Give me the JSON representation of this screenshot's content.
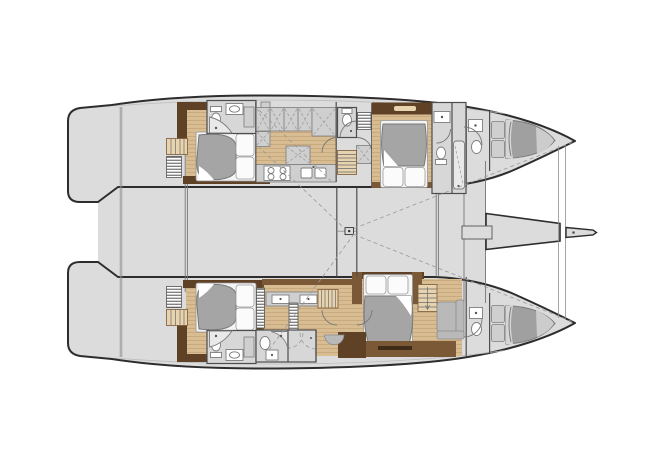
{
  "meta": {
    "type": "floorplan",
    "subject": "catamaran-yacht-interior-deck-plan",
    "orientation": "bow-right",
    "text_visible": "none"
  },
  "colors": {
    "background": "#ffffff",
    "hull_fill": "#dcdcdc",
    "hull_outline": "#2d2d2d",
    "wall": "#4d4d4d",
    "bath": "#d7d7d7",
    "wood": "#d8bc92",
    "wood_line": "#c2a276",
    "wood_light": "#e7d4ae",
    "brown_dark": "#5f4125",
    "brown_mid": "#7b5936",
    "counter": "#cfcfcf",
    "counter_line": "#7d7d7d",
    "fixture": "#ffffff",
    "duvet": "#a5a5a5",
    "duvet_dark": "#787878",
    "crew_bed": "#a0a0a0",
    "crew_bed_light": "#cccccc",
    "pillow": "#fbfbfb",
    "sofa": "#b9b9b9",
    "dash": "#999999"
  },
  "inventory": {
    "double_cabins": 4,
    "bow_crew_cabins": 2,
    "toilets": 7,
    "showers": 5,
    "stove_burners": 4,
    "galley_sink_bowls": 2,
    "owner_vanity_basins": 2,
    "stair_flights": 4,
    "swim_platforms": 2
  }
}
